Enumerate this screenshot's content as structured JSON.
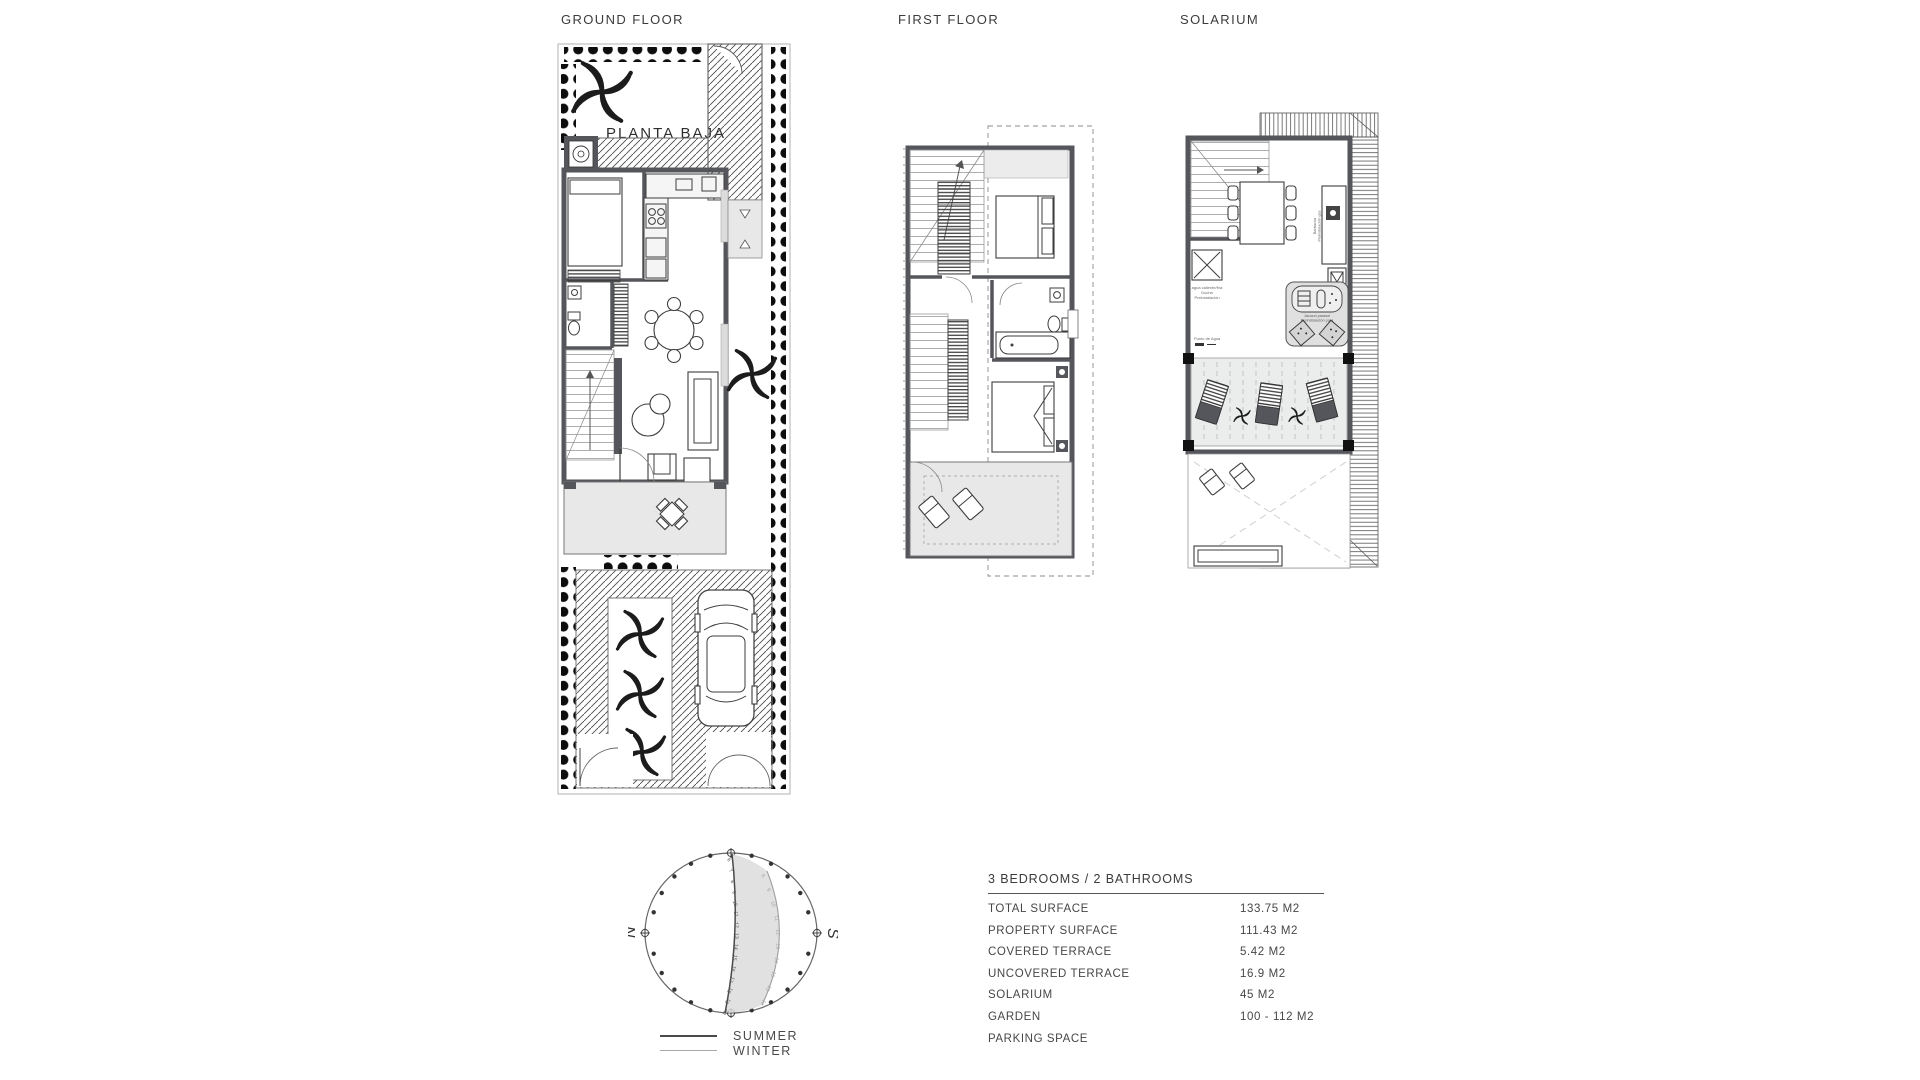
{
  "plans": {
    "ground_floor": {
      "title": "GROUND FLOOR",
      "room_label": "PLANTA BAJA"
    },
    "first_floor": {
      "title": "FIRST FLOOR"
    },
    "solarium": {
      "title": "SOLARIUM",
      "annotations": {
        "shower_1": "agua caliente/fría",
        "shower_2": "Ducha",
        "shower_3": "Preinstalación",
        "water_point": "Punto de Agua",
        "bbq_1": "Barbacoa",
        "bbq_2": "Preinstalación gas",
        "jacuzzi_1": "Jacuzzi parasol",
        "jacuzzi_2": "Preinstalación para"
      }
    }
  },
  "sun_diagram": {
    "north": "N",
    "south": "S",
    "legend": {
      "summer": "SUMMER",
      "winter": "WINTER"
    },
    "summer_hours": [
      "6",
      "7",
      "8",
      "9",
      "10",
      "11",
      "12",
      "13",
      "14",
      "15",
      "16",
      "17",
      "18",
      "19",
      "20"
    ],
    "winter_hours": [
      "8",
      "9",
      "10",
      "11",
      "12",
      "13",
      "14",
      "15",
      "16",
      "17"
    ]
  },
  "specs": {
    "title": "3 BEDROOMS / 2 BATHROOMS",
    "rows": [
      {
        "label": "TOTAL SURFACE",
        "value": "133.75 M2"
      },
      {
        "label": "PROPERTY SURFACE",
        "value": "111.43 M2"
      },
      {
        "label": "COVERED TERRACE",
        "value": "5.42 M2"
      },
      {
        "label": "UNCOVERED TERRACE",
        "value": "16.9 M2"
      },
      {
        "label": "SOLARIUM",
        "value": "45 M2"
      },
      {
        "label": "GARDEN",
        "value": "100 - 112 M2"
      },
      {
        "label": "PARKING SPACE",
        "value": ""
      }
    ]
  },
  "colors": {
    "wall": "#55565b",
    "terrace_fill": "#e8e8e8",
    "dot": "#0d0d0d",
    "text": "#3e3e3e",
    "summer_line": "#4a4a4a",
    "winter_line": "#a9a9a9",
    "sun_shade": "#dcdcdc"
  }
}
